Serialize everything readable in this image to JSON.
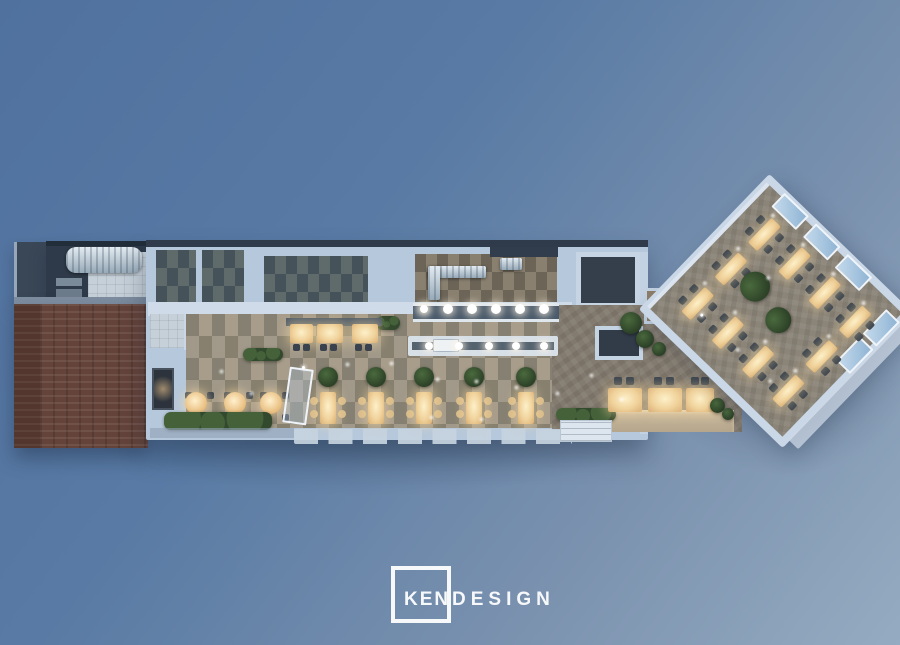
{
  "scene": {
    "description": "Aerial 3D render of a long restaurant floor plan on a blue gradient backdrop",
    "background_gradient_start": "#50719e",
    "background_gradient_end": "#95abc1"
  },
  "logo": {
    "ken": "KEN",
    "design": "DESIGN"
  },
  "palette": {
    "wall_light": "#c9d7e6",
    "roof_dark": "#2f3b4a",
    "brick_red": "#64433a",
    "floor_tan_checker": "#9b9283",
    "floor_dark_checker": "#4f5a5e",
    "floor_herringbone": "#837b6f",
    "table_glow": "#f6e3b4",
    "plant_green": "#33492d",
    "window_glass": "#a9c6e0",
    "light_white": "#ffffff"
  }
}
